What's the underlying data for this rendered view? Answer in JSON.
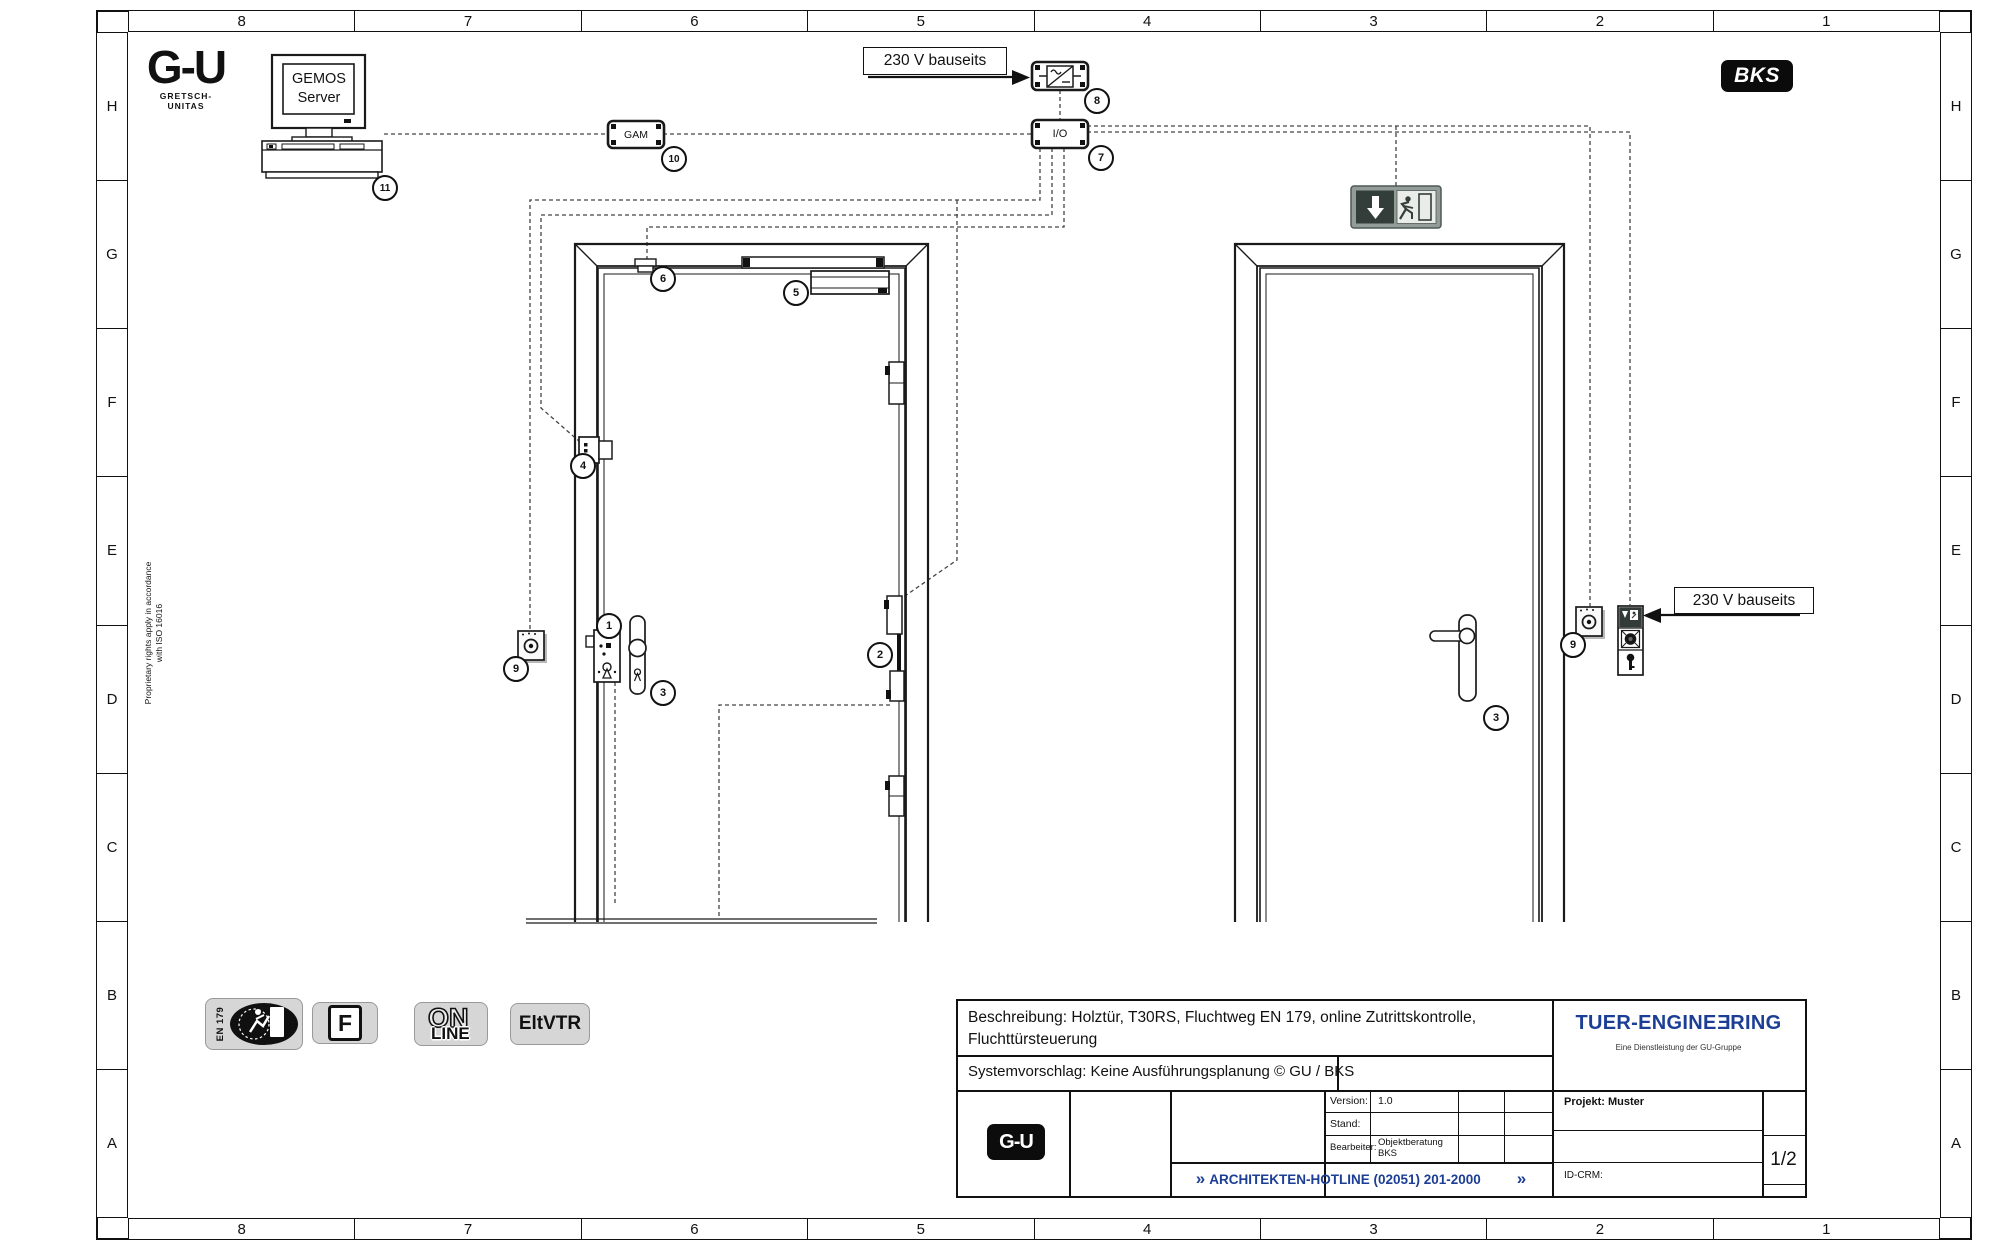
{
  "frame": {
    "columns": [
      "8",
      "7",
      "6",
      "5",
      "4",
      "3",
      "2",
      "1"
    ],
    "rows": [
      "H",
      "G",
      "F",
      "E",
      "D",
      "C",
      "B",
      "A"
    ]
  },
  "header": {
    "gu_logo": "G-U",
    "gu_logo_sub": "GRETSCH-UNITAS",
    "bks_logo": "BKS",
    "server_line1": "GEMOS",
    "server_line2": "Server",
    "gam_label": "GAM",
    "io_label": "I/O",
    "power_label_top": "230 V bauseits"
  },
  "drawing": {
    "power_label_right": "230 V bauseits",
    "proprietary_line1": "Proprietary rights apply in accordance",
    "proprietary_line2": "with ISO 16016",
    "callouts": [
      "1",
      "2",
      "3",
      "4",
      "5",
      "6",
      "7",
      "8",
      "9",
      "10",
      "11",
      "9",
      "3"
    ]
  },
  "badges": {
    "en179": "EN 179",
    "fire": "F",
    "online_top": "ON",
    "online_bottom": "LINE",
    "eltvtr": "EltVTR"
  },
  "titleblock": {
    "beschreibung": "Beschreibung: Holztür, T30RS, Fluchtweg EN 179, online Zutrittskontrolle, Fluchttürsteuerung",
    "systemvorschlag": "Systemvorschlag: Keine Ausführungsplanung © GU / BKS",
    "version_label": "Version:",
    "version_value": "1.0",
    "stand_label": "Stand:",
    "stand_value": "",
    "bearbeiter_label": "Bearbeiter:",
    "bearbeiter_value": "Objektberatung BKS",
    "projekt": "Projekt: Muster",
    "id_crm": "ID-CRM:",
    "page": "1/2",
    "chevron": "»",
    "hotline": "ARCHITEKTEN-HOTLINE (02051) 201-2000",
    "gu_small": "G-U",
    "brand_a": "TUER-ENGINE",
    "brand_b": "E",
    "brand_c": "RING",
    "brand_sub": "Eine Dienstleistung der GU-Gruppe"
  },
  "colors": {
    "accent_blue": "#1c3e94",
    "line": "#1a1a1a",
    "badge_gray": "#d6d6d6",
    "exit_green": "#333e3a"
  }
}
